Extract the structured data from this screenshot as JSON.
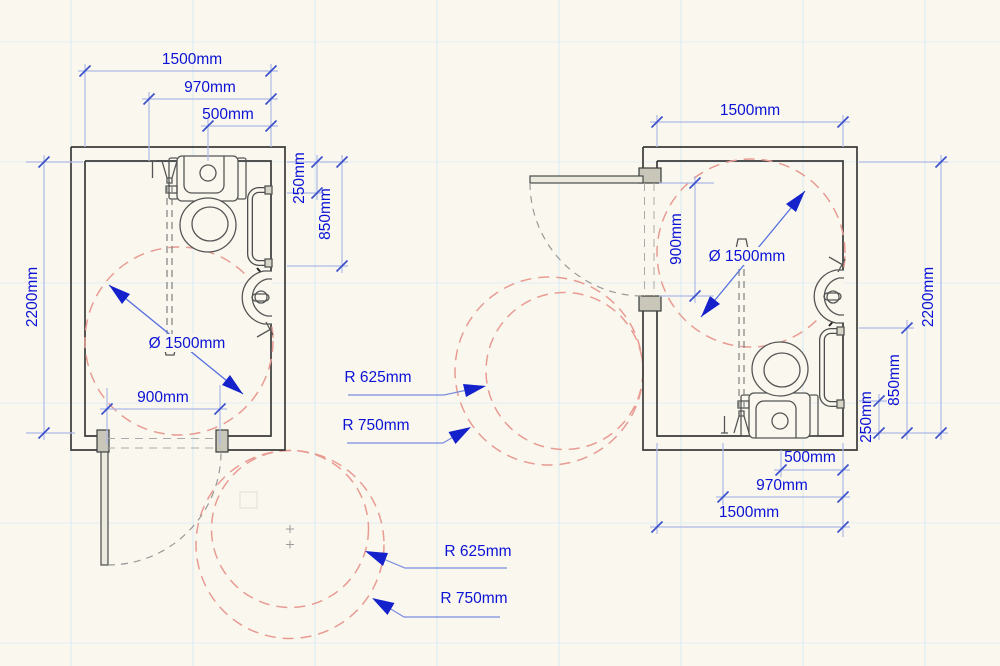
{
  "meta": {
    "drawing_type": "accessible WC plan pair",
    "units": "mm"
  },
  "colors": {
    "background": "#faf8ee",
    "dimension_text": "#0b12d6",
    "dimension_line": "#aeb9e6",
    "tick": "#3a50cc",
    "arrow": "#1522cc",
    "turning_circle": "#e89b93",
    "wall": "#3a3a3a",
    "fixture": "#555555",
    "door_swing": "#999999",
    "grid": "#d6e7f1"
  },
  "left_room": {
    "width": "1500mm",
    "rail_offset": "970mm",
    "pan_centre": "500mm",
    "depth": "2200mm",
    "cistern_front": "250mm",
    "pan_front": "850mm",
    "door_opening": "900mm",
    "turning_diameter": "Ø 1500mm"
  },
  "right_room": {
    "width": "1500mm",
    "door_opening": "900mm",
    "turning_diameter": "Ø 1500mm",
    "depth": "2200mm",
    "pan_front": "850mm",
    "cistern_front": "250mm",
    "pan_centre": "500mm",
    "rail_offset": "970mm",
    "width_bottom": "1500mm"
  },
  "circles": {
    "middle": {
      "inner_radius": "R 625mm",
      "outer_radius": "R 750mm"
    },
    "bottom": {
      "inner_radius": "R 625mm",
      "outer_radius": "R 750mm"
    }
  }
}
